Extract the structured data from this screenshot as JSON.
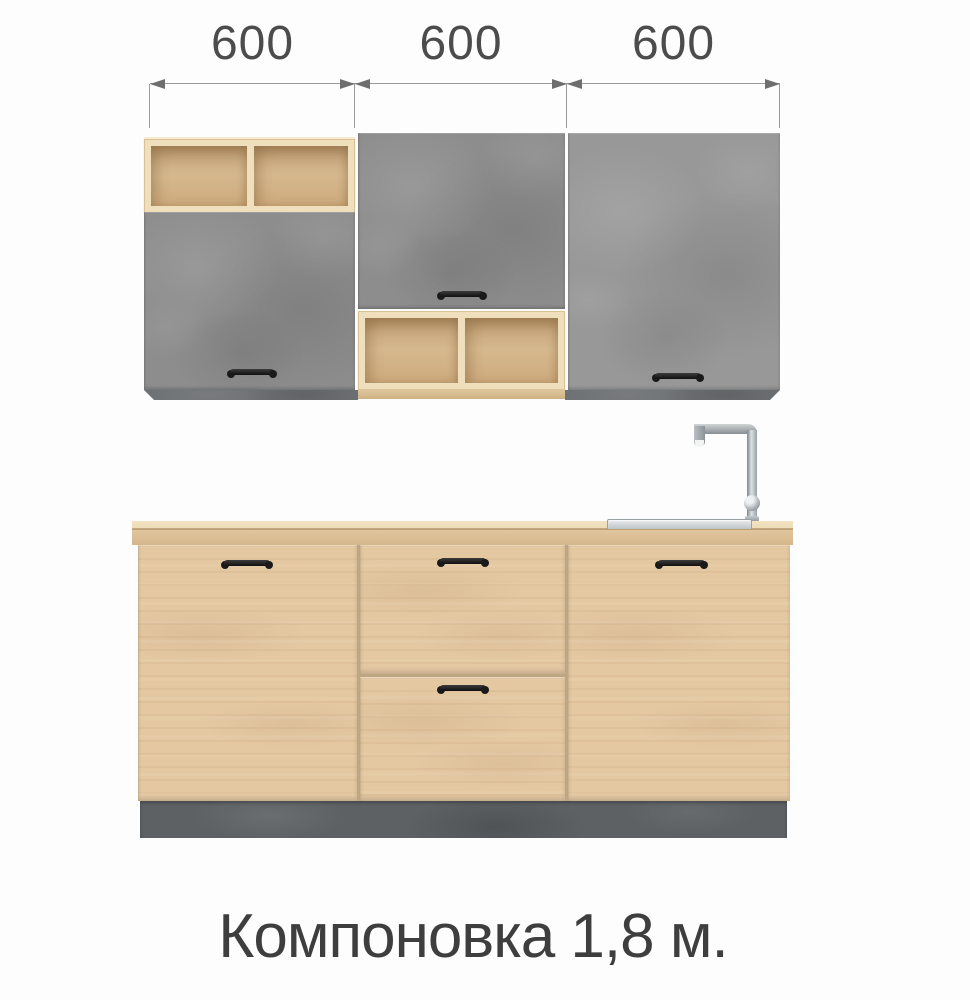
{
  "caption": {
    "text": "Компоновка 1,8 м."
  },
  "dimensions": {
    "unit": "mm",
    "segments": [
      {
        "label": "600"
      },
      {
        "label": "600"
      },
      {
        "label": "600"
      }
    ],
    "total_label_meters": "1,8"
  },
  "scene": {
    "upper_row_sections": [
      {
        "width": "600",
        "composition": "open-shelf-above-concrete-door"
      },
      {
        "width": "600",
        "composition": "concrete-door-above-open-shelf"
      },
      {
        "width": "600",
        "composition": "full-height-concrete-door"
      }
    ],
    "base_row_sections": [
      {
        "width": "600",
        "composition": "oak-door"
      },
      {
        "width": "600",
        "composition": "two-oak-drawers"
      },
      {
        "width": "600",
        "composition": "oak-door-with-sink-and-faucet"
      }
    ],
    "fixtures": [
      "inset-sink",
      "chrome-faucet",
      "concrete-plinth"
    ]
  },
  "colors": {
    "background": "#fdfdfd",
    "concrete": "#8d8d8d",
    "concrete-light": "#989898",
    "concrete-dark": "#6e7173",
    "plinth": "#5d6164",
    "wood-front": "#e4c8a2",
    "wood-seam": "#bda681",
    "wood-frame": "#f0dfbd",
    "wood-under": "#dfc69c",
    "countertop-top": "#eedcb8",
    "countertop-front": "#e2c69e",
    "handle": "#1a1a1a",
    "dimension-line": "#9a9a9a",
    "dimension-arrow": "#6e6e6e",
    "dimension-text": "#4c4c4c",
    "caption-text": "#3e3e3e",
    "steel-light": "#e8eced",
    "steel-mid": "#b9bfc2",
    "steel-dark": "#878e92"
  }
}
